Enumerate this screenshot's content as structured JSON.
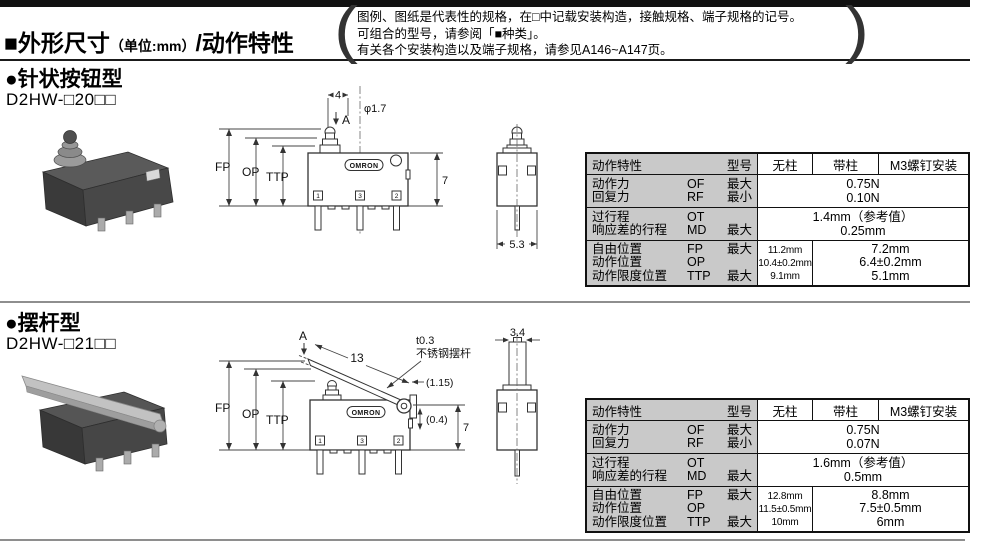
{
  "header": {
    "title": "■外形尺寸",
    "unit": "（单位:mm）",
    "suffix": "/动作特性",
    "note_line1": "图例、图纸是代表性的规格，在□中记载安装构造，接触规格、端子规格的记号。",
    "note_line2": "可组合的型号，请参阅「■种类」。",
    "note_line3": "有关各个安装构造以及端子规格，请参见A146~A147页。"
  },
  "sections": [
    {
      "heading": "●针状按钮型",
      "model": "D2HW-□20□□",
      "diagram": {
        "dim_top": "4",
        "dim_diameter": "φ1.7",
        "label_a": "A",
        "pos_fp": "FP",
        "pos_op": "OP",
        "pos_ttp": "TTP",
        "dim_height": "7",
        "dim_side_width": "5.3",
        "brand": "OMRON",
        "terminals": [
          "1",
          "3",
          "2"
        ]
      },
      "table": {
        "corner_left": "动作特性",
        "corner_right": "型号",
        "columns": [
          "无柱",
          "带柱",
          "M3螺钉安装"
        ],
        "rows": [
          {
            "lines": [
              {
                "name": "动作力",
                "code": "OF",
                "qual": "最大"
              },
              {
                "name": "回复力",
                "code": "RF",
                "qual": "最小"
              }
            ],
            "values": [
              "0.75N",
              "0.10N"
            ]
          },
          {
            "lines": [
              {
                "name": "过行程",
                "code": "OT",
                "qual": ""
              },
              {
                "name": "响应差的行程",
                "code": "MD",
                "qual": "最大"
              }
            ],
            "values": [
              "1.4mm（参考值）",
              "0.25mm"
            ]
          },
          {
            "lines": [
              {
                "name": "自由位置",
                "code": "FP",
                "qual": "最大"
              },
              {
                "name": "动作位置",
                "code": "OP",
                "qual": ""
              },
              {
                "name": "动作限度位置",
                "code": "TTP",
                "qual": "最大"
              }
            ],
            "col_no_post": [
              "11.2mm",
              "10.4±0.2mm",
              "9.1mm"
            ],
            "col_post_m3": [
              "7.2mm",
              "6.4±0.2mm",
              "5.1mm"
            ]
          }
        ]
      }
    },
    {
      "heading": "●摆杆型",
      "model": "D2HW-□21□□",
      "diagram": {
        "label_a": "A",
        "dim_lever": "13",
        "lever_thickness": "t0.3",
        "lever_material": "不锈钢摆杆",
        "dim_off1": "(1.15)",
        "dim_off2": "(0.4)",
        "pos_fp": "FP",
        "pos_op": "OP",
        "pos_ttp": "TTP",
        "dim_height": "7",
        "dim_side_width": "3.4",
        "brand": "OMRON",
        "terminals": [
          "1",
          "3",
          "2"
        ]
      },
      "table": {
        "corner_left": "动作特性",
        "corner_right": "型号",
        "columns": [
          "无柱",
          "带柱",
          "M3螺钉安装"
        ],
        "rows": [
          {
            "lines": [
              {
                "name": "动作力",
                "code": "OF",
                "qual": "最大"
              },
              {
                "name": "回复力",
                "code": "RF",
                "qual": "最小"
              }
            ],
            "values": [
              "0.75N",
              "0.07N"
            ]
          },
          {
            "lines": [
              {
                "name": "过行程",
                "code": "OT",
                "qual": ""
              },
              {
                "name": "响应差的行程",
                "code": "MD",
                "qual": "最大"
              }
            ],
            "values": [
              "1.6mm（参考值）",
              "0.5mm"
            ]
          },
          {
            "lines": [
              {
                "name": "自由位置",
                "code": "FP",
                "qual": "最大"
              },
              {
                "name": "动作位置",
                "code": "OP",
                "qual": ""
              },
              {
                "name": "动作限度位置",
                "code": "TTP",
                "qual": "最大"
              }
            ],
            "col_no_post": [
              "12.8mm",
              "11.5±0.5mm",
              "10mm"
            ],
            "col_post_m3": [
              "8.8mm",
              "7.5±0.5mm",
              "6mm"
            ]
          }
        ]
      }
    }
  ]
}
